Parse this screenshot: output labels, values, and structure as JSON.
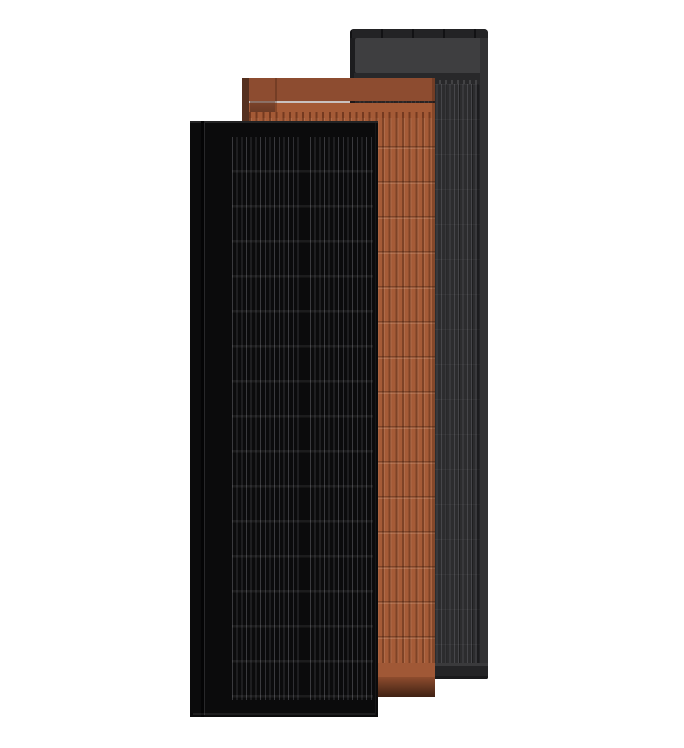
{
  "scene": {
    "description": "Product render of three overlapping solar roof panels on a white background",
    "panels": [
      {
        "id": "black-solar-panel",
        "stack_position": "front",
        "finish": "matte black",
        "cell_column_groups": 2,
        "cell_rows": 16
      },
      {
        "id": "terracotta-solar-tile",
        "stack_position": "middle",
        "finish": "terracotta ribbed",
        "rib_rows": 16
      },
      {
        "id": "graphite-solar-panel",
        "stack_position": "back",
        "finish": "dark graphite",
        "has_top_header": true
      }
    ]
  },
  "colors": {
    "page-bg": "#ffffff",
    "black-panel-body": "#0b0b0c",
    "black-panel-stripe": "#303034",
    "black-panel-bevel": "#28282a",
    "terra-left-edge": "#55301f",
    "terra-band-upper": "#8d4c30",
    "terra-band-lower": "#a45a36",
    "terra-base": "#a55b37",
    "terra-lock-shadow": "#5c3221",
    "terra-bottom-band": "#a05836",
    "terra-shadow-start": "#8e4c2e",
    "terra-shadow-end": "#3f2113",
    "gray-frame": "#1d1d1f",
    "gray-topbar": "#232325",
    "gray-topbar-tick": "#121214",
    "gray-header": "#3e3e40",
    "gray-groove": "#28282a",
    "gray-cell-base": "#2c2c2e",
    "gray-cell-stripe": "#46464a",
    "gray-right-frame": "#323234",
    "gray-bottom-bar": "#242426",
    "gray-bottom-line": "#3a3a3c"
  }
}
